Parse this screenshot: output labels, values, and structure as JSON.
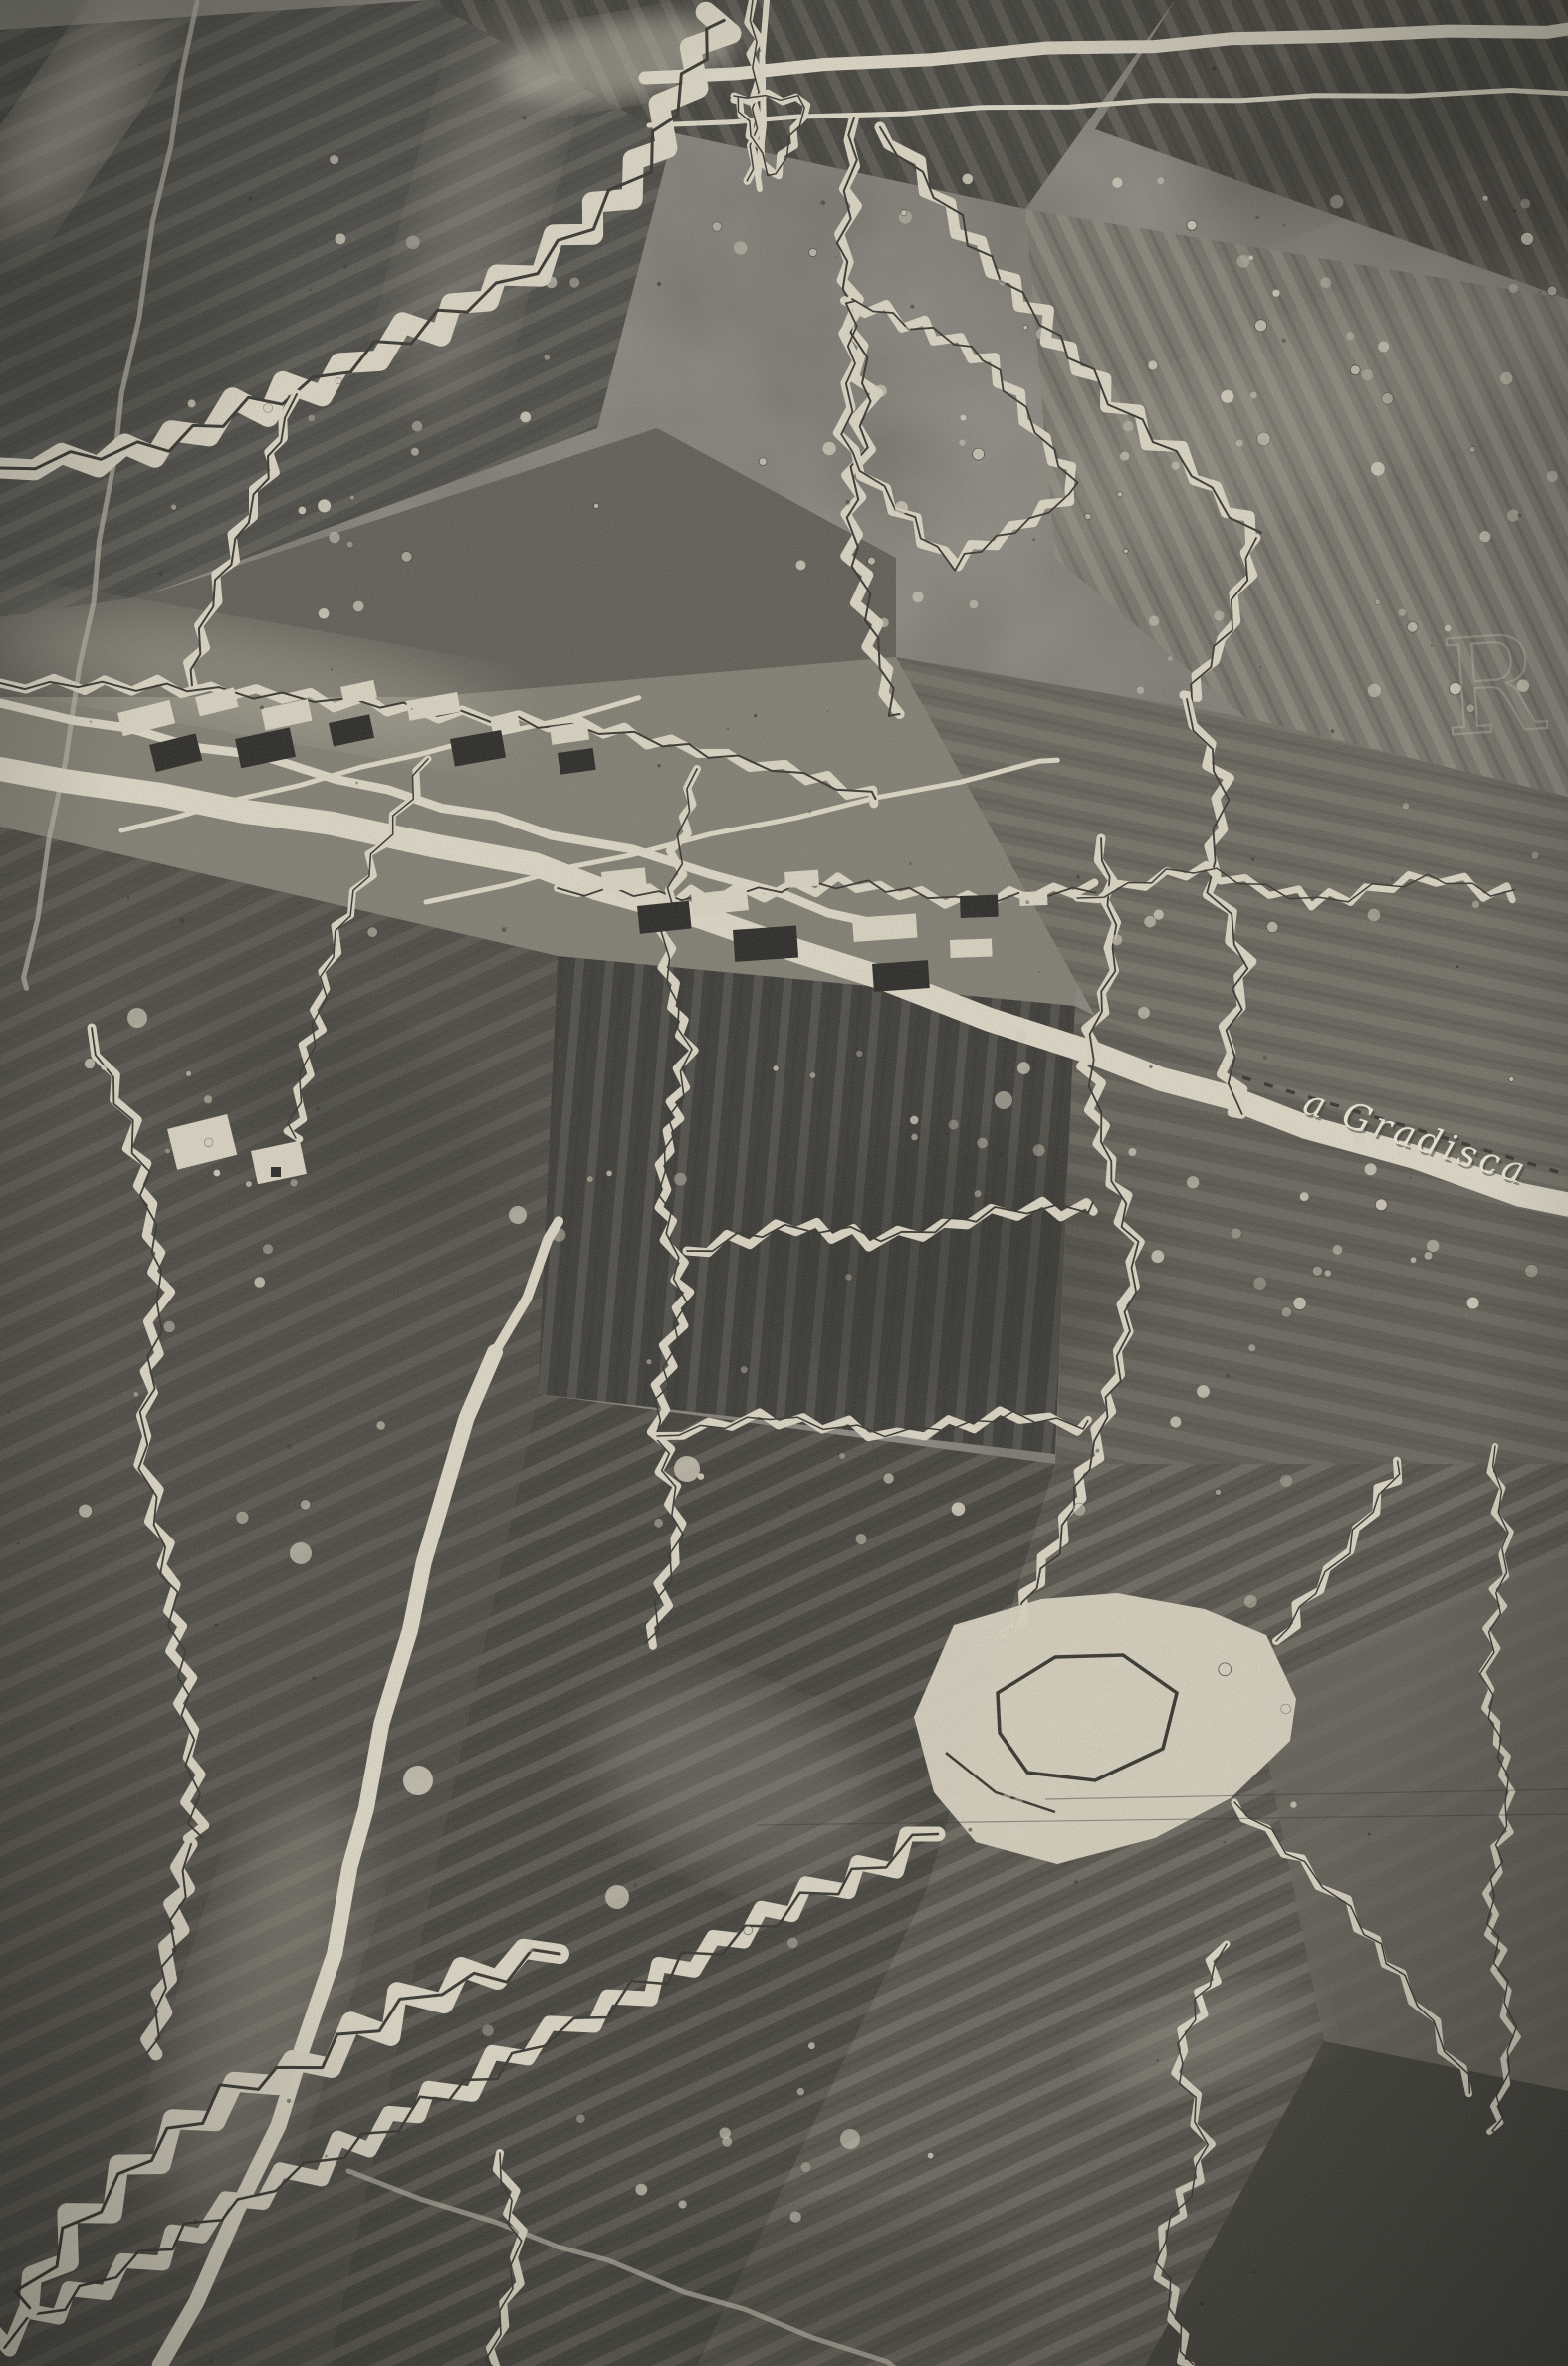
{
  "photo": {
    "road_label": "a Gradisca",
    "watermark_letter": "R"
  },
  "palette": {
    "background": "#7b7972",
    "trench_band": "#dbd5c4",
    "trench_core": "#2e2d28",
    "road_light": "#ddd7c6",
    "field_dark": "#343330",
    "field_mid": "#716f66",
    "building_white": "#d9d3c2",
    "building_dark": "#222120",
    "label_ink": "#ece6d6"
  },
  "features": {
    "subject": "aerial photograph of trench lines, roads and ruined village",
    "visible_text": [
      "a Gradisca",
      "R"
    ]
  }
}
